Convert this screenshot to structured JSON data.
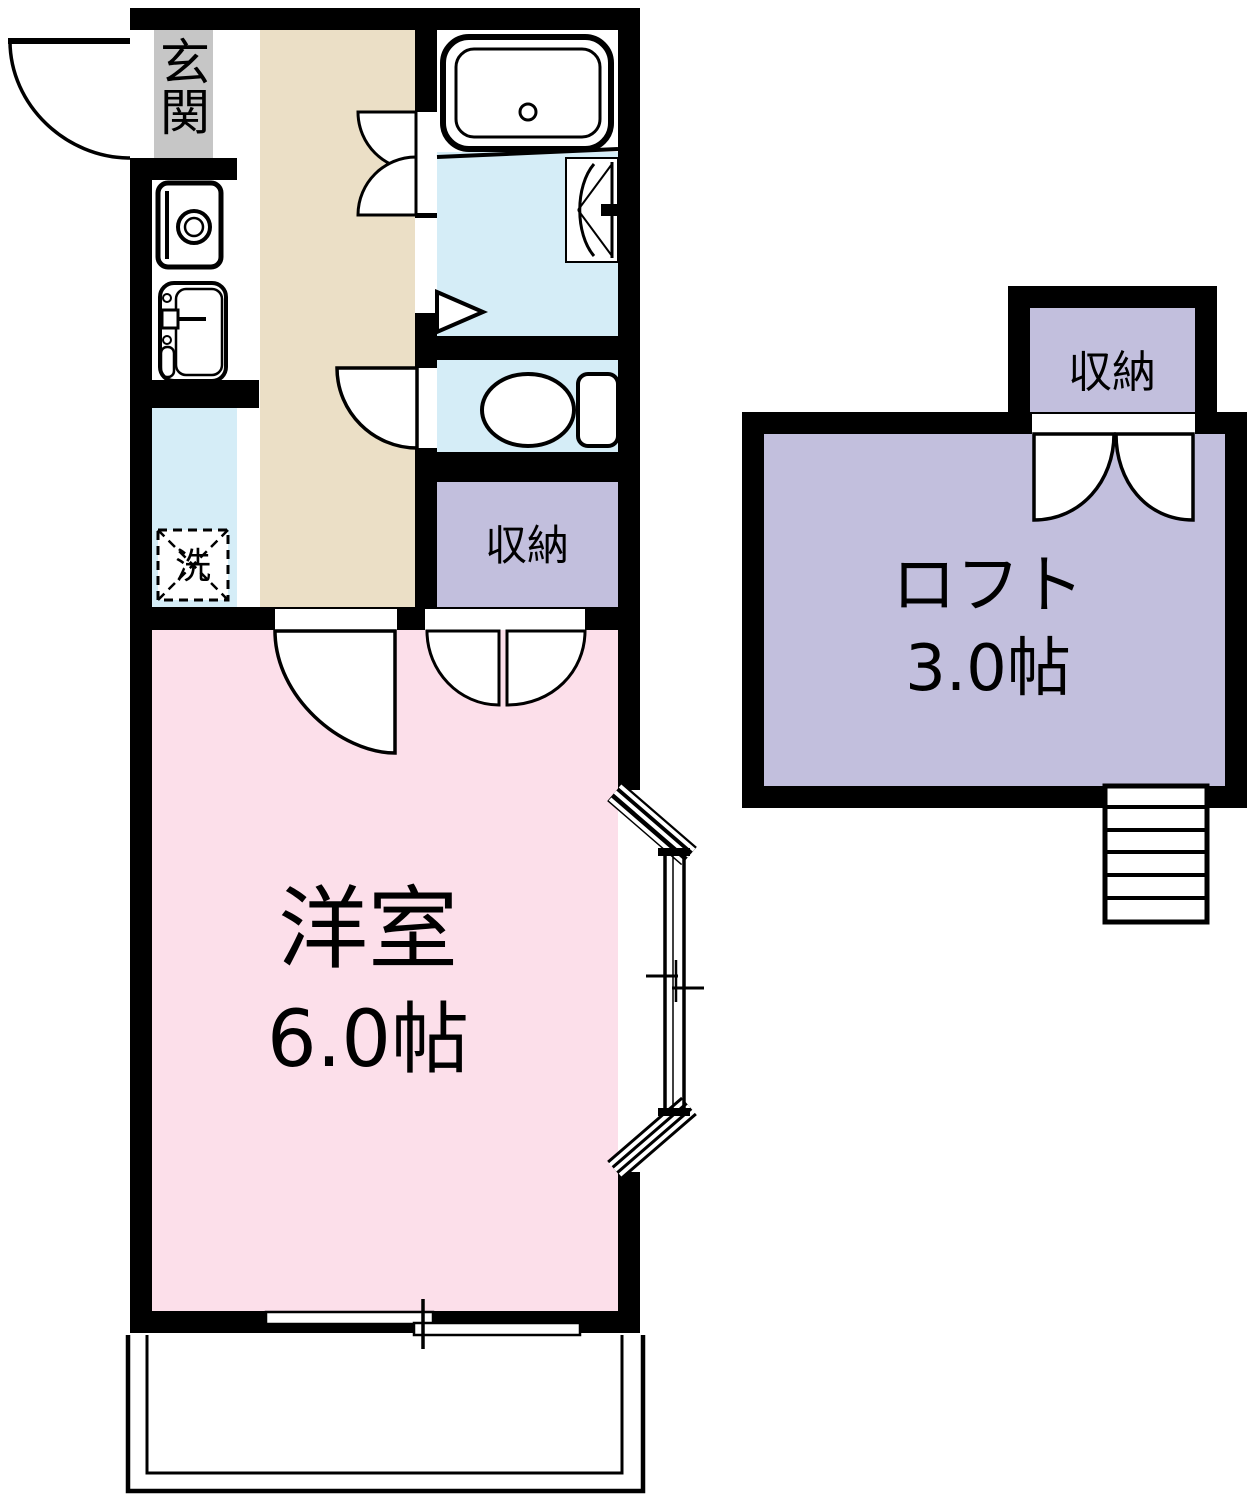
{
  "colors": {
    "wall": "#000000",
    "kitchen_floor": "#EBDFC6",
    "room_floor": "#FCDFEA",
    "wet_floor": "#D5EDF7",
    "storage_floor": "#C2BFDD",
    "entrance_floor": "#C6C6C6",
    "line": "#000000",
    "background": "#FFFFFF"
  },
  "labels": {
    "entrance": "玄関",
    "washer": "洗",
    "storage": "収納",
    "western_room": "洋室",
    "western_room_size": "6.0帖",
    "loft": "ロフト",
    "loft_size": "3.0帖",
    "loft_storage": "収納"
  }
}
